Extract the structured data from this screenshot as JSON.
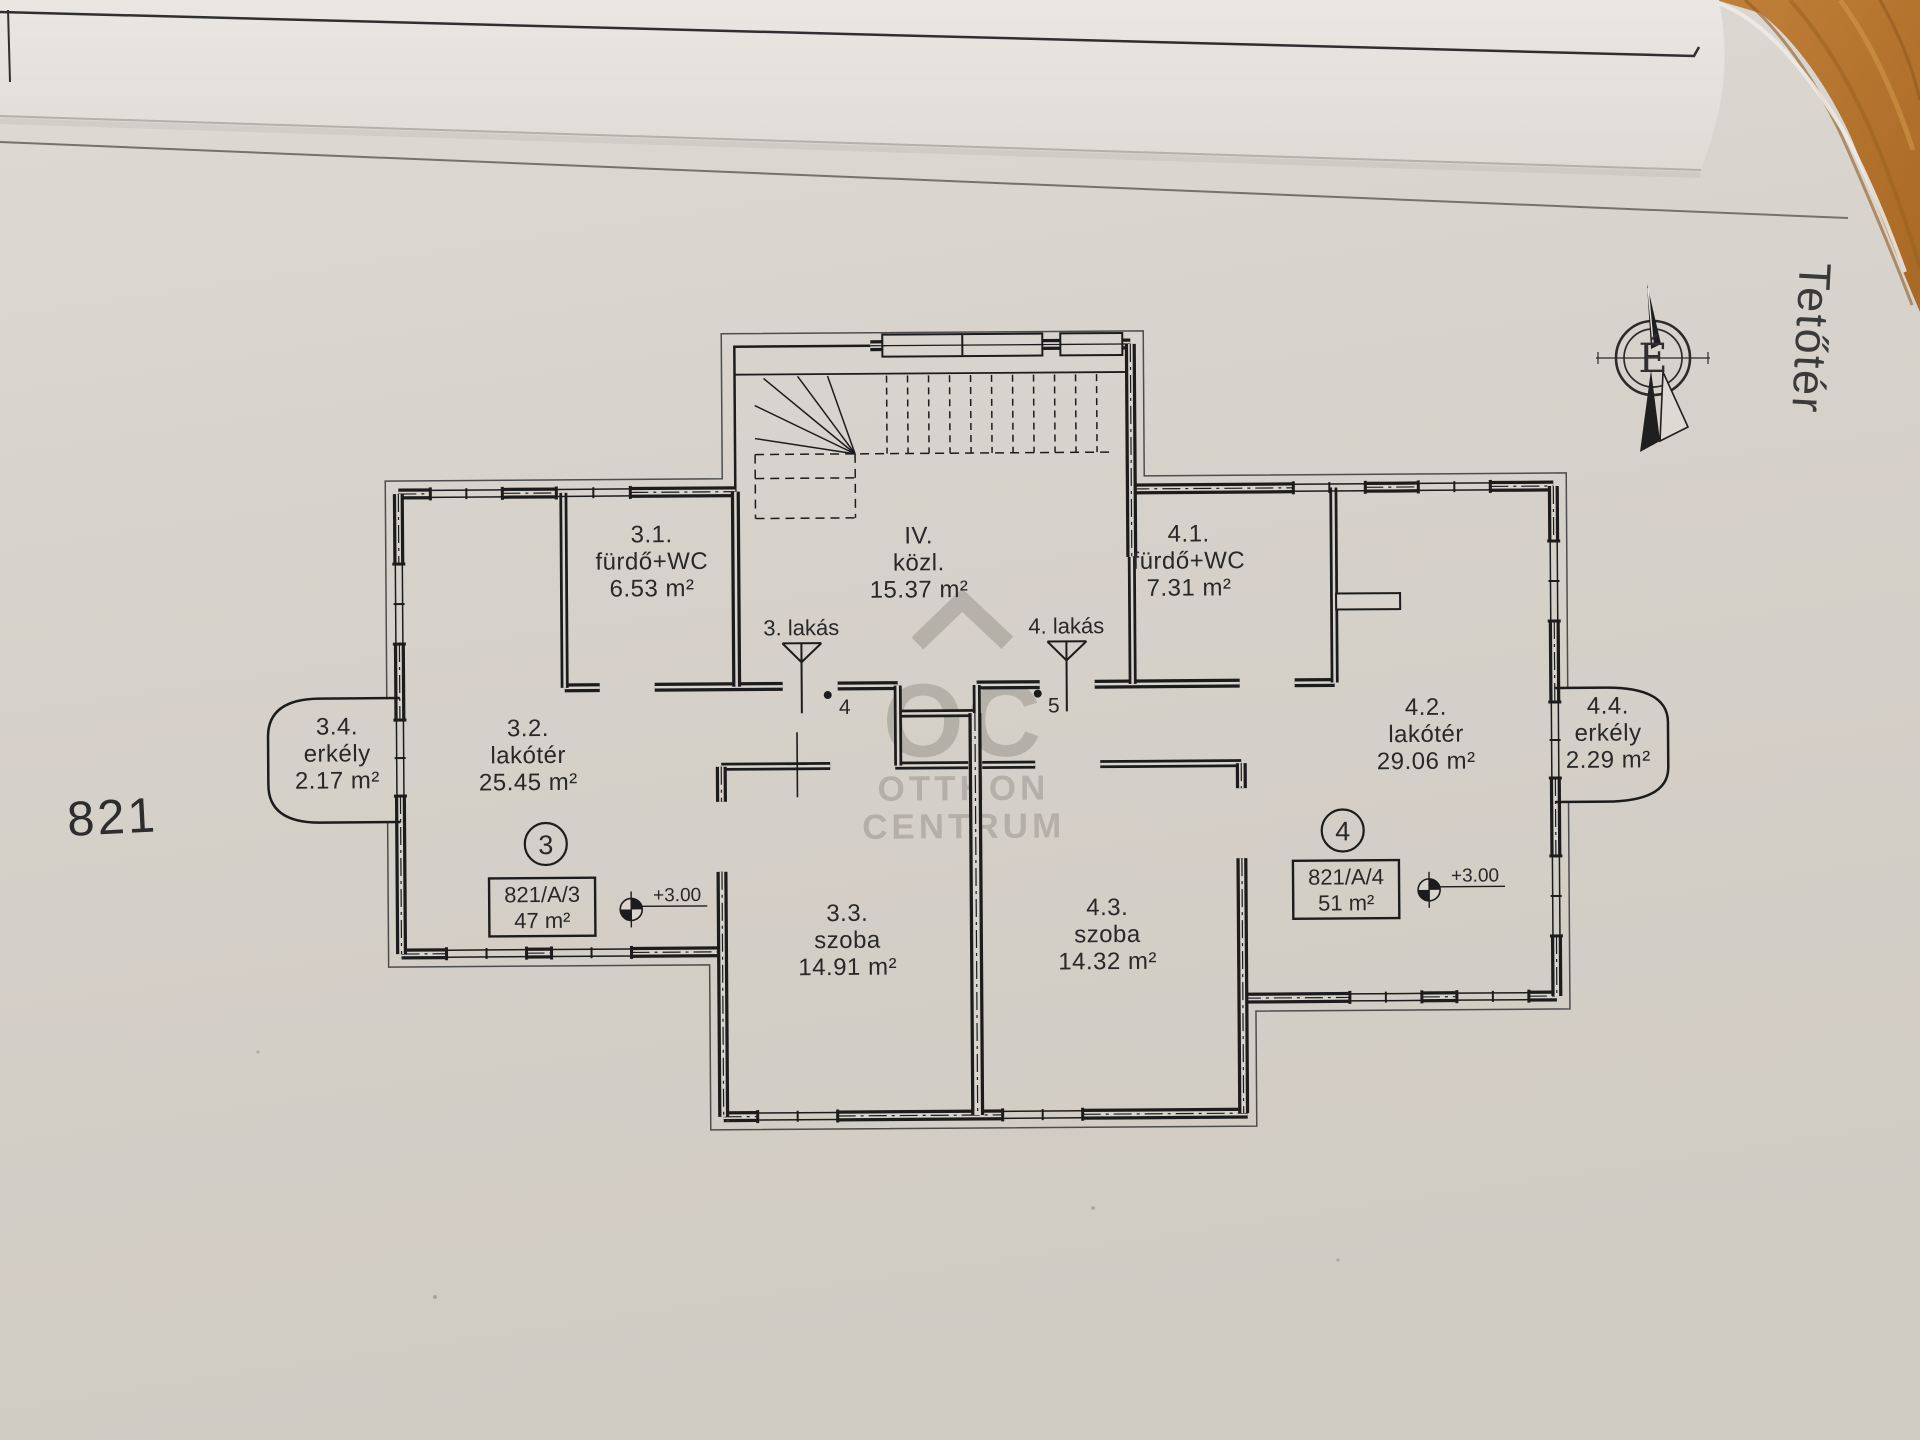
{
  "page": {
    "sheet_number": "821",
    "floor_title": "Tetőtér",
    "compass_letter": "É"
  },
  "watermark": {
    "mark": "OC",
    "line1": "OTTHON",
    "line2": "CENTRUM"
  },
  "rooms": [
    {
      "no": "3.1.",
      "name": "fürdő+WC",
      "area": "6.53 m²"
    },
    {
      "no": "IV.",
      "name": "közl.",
      "area": "15.37 m²"
    },
    {
      "no": "4.1.",
      "name": "fürdő+WC",
      "area": "7.31 m²"
    },
    {
      "no": "3.4.",
      "name": "erkély",
      "area": "2.17 m²"
    },
    {
      "no": "3.2.",
      "name": "lakótér",
      "area": "25.45 m²"
    },
    {
      "no": "4.2.",
      "name": "lakótér",
      "area": "29.06 m²"
    },
    {
      "no": "4.4.",
      "name": "erkély",
      "area": "2.29 m²"
    },
    {
      "no": "3.3.",
      "name": "szoba",
      "area": "14.91 m²"
    },
    {
      "no": "4.3.",
      "name": "szoba",
      "area": "14.32 m²"
    }
  ],
  "apartments": [
    {
      "badge": "3",
      "lot": "821/A/3",
      "area": "47 m²",
      "level": "+3.00"
    },
    {
      "badge": "4",
      "lot": "821/A/4",
      "area": "51 m²",
      "level": "+3.00"
    }
  ],
  "entrances": [
    {
      "label": "3. lakás",
      "point": "4"
    },
    {
      "label": "4. lakás",
      "point": "5"
    }
  ],
  "colors": {
    "paper": "#d6d1ca",
    "top_sheet": "#e8e5e0",
    "ink": "#1c1c1c",
    "watermark_gray": "#96918a",
    "wood": "#b4742e"
  }
}
